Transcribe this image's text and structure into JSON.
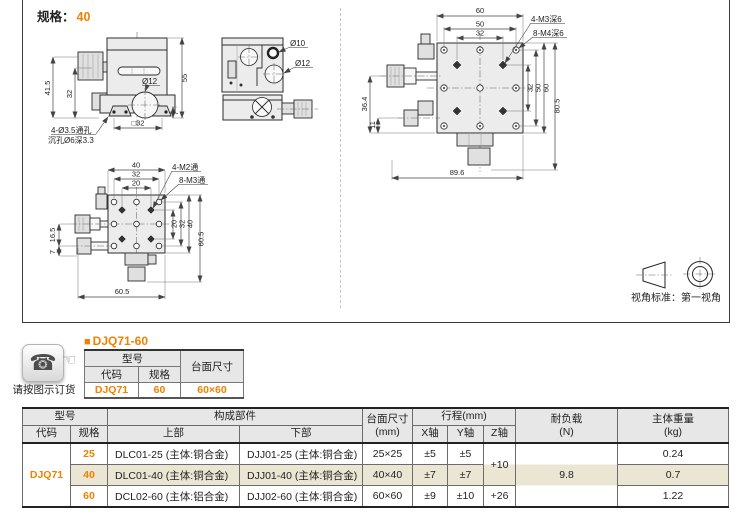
{
  "colors": {
    "accent_orange": "#ef8200",
    "header_gray": "#e7e7e7",
    "highlight_beige": "#ebe6d3",
    "line_dark": "#2b2b2b"
  },
  "header": {
    "spec_label": "规格：",
    "spec_value": "40"
  },
  "drawings": {
    "front": {
      "d41_5": "41.5",
      "d32": "32",
      "d55": "55",
      "d7": "7",
      "dsq32": "□32",
      "dia12": "Ø12",
      "note1": "4-Ø3.5通孔",
      "note2": "沉孔Ø6深3.3"
    },
    "side": {
      "dia10": "Ø10",
      "dia12": "Ø12"
    },
    "top": {
      "d60": "60",
      "d50": "50",
      "d32t": "32",
      "m3": "4-M3深6",
      "m4": "8-M4深6",
      "d36_4": "36.4",
      "d11": "11",
      "d32r": "32",
      "d50r": "50",
      "d60r": "60",
      "d80_5": "80.5",
      "d89_6": "89.6"
    },
    "bottom": {
      "d40": "40",
      "d32": "32",
      "d20": "20",
      "m2": "4-M2通",
      "m3": "8-M3通",
      "d16_5": "16.5",
      "d7": "7",
      "d20r": "20",
      "d32r": "32",
      "d40r": "40",
      "d60_5r": "60.5",
      "d60_5b": "60.5"
    },
    "projection": {
      "caption": "视角标准：第一视角"
    }
  },
  "ordering": {
    "phone_icon": "☎",
    "hand_icon": "☜",
    "phone_caption": "请按图示订货",
    "bullet": "■",
    "title": "DJQ71-60",
    "table": {
      "model_header": "型号",
      "surface_header": "台面尺寸",
      "code_header": "代码",
      "spec_header": "规格",
      "code": "DJQ71",
      "spec": "60",
      "surface": "60×60"
    }
  },
  "spec_table": {
    "headers": {
      "model": "型号",
      "code": "代码",
      "spec": "规格",
      "components": "构成部件",
      "upper": "上部",
      "lower": "下部",
      "surface_l1": "台面尺寸",
      "surface_l2": "(mm)",
      "travel": "行程(mm)",
      "x_axis": "X轴",
      "y_axis": "Y轴",
      "z_axis": "Z轴",
      "load_l1": "耐负载",
      "load_l2": "(N)",
      "weight_l1": "主体重量",
      "weight_l2": "(kg)"
    },
    "code": "DJQ71",
    "load": "9.8",
    "z_row12": "+10",
    "z_row3": "+26",
    "rows": [
      {
        "spec": "25",
        "upper": "DLC01-25 (主体:铜合金)",
        "lower": "DJJ01-25 (主体:铜合金)",
        "surface": "25×25",
        "x": "±5",
        "y": "±5",
        "weight": "0.24"
      },
      {
        "spec": "40",
        "upper": "DLC01-40 (主体:铜合金)",
        "lower": "DJJ01-40 (主体:铜合金)",
        "surface": "40×40",
        "x": "±7",
        "y": "±7",
        "weight": "0.7"
      },
      {
        "spec": "60",
        "upper": "DCL02-60 (主体:铝合金)",
        "lower": "DJJ02-60 (主体:铜合金)",
        "surface": "60×60",
        "x": "±9",
        "y": "±10",
        "weight": "1.22"
      }
    ]
  }
}
